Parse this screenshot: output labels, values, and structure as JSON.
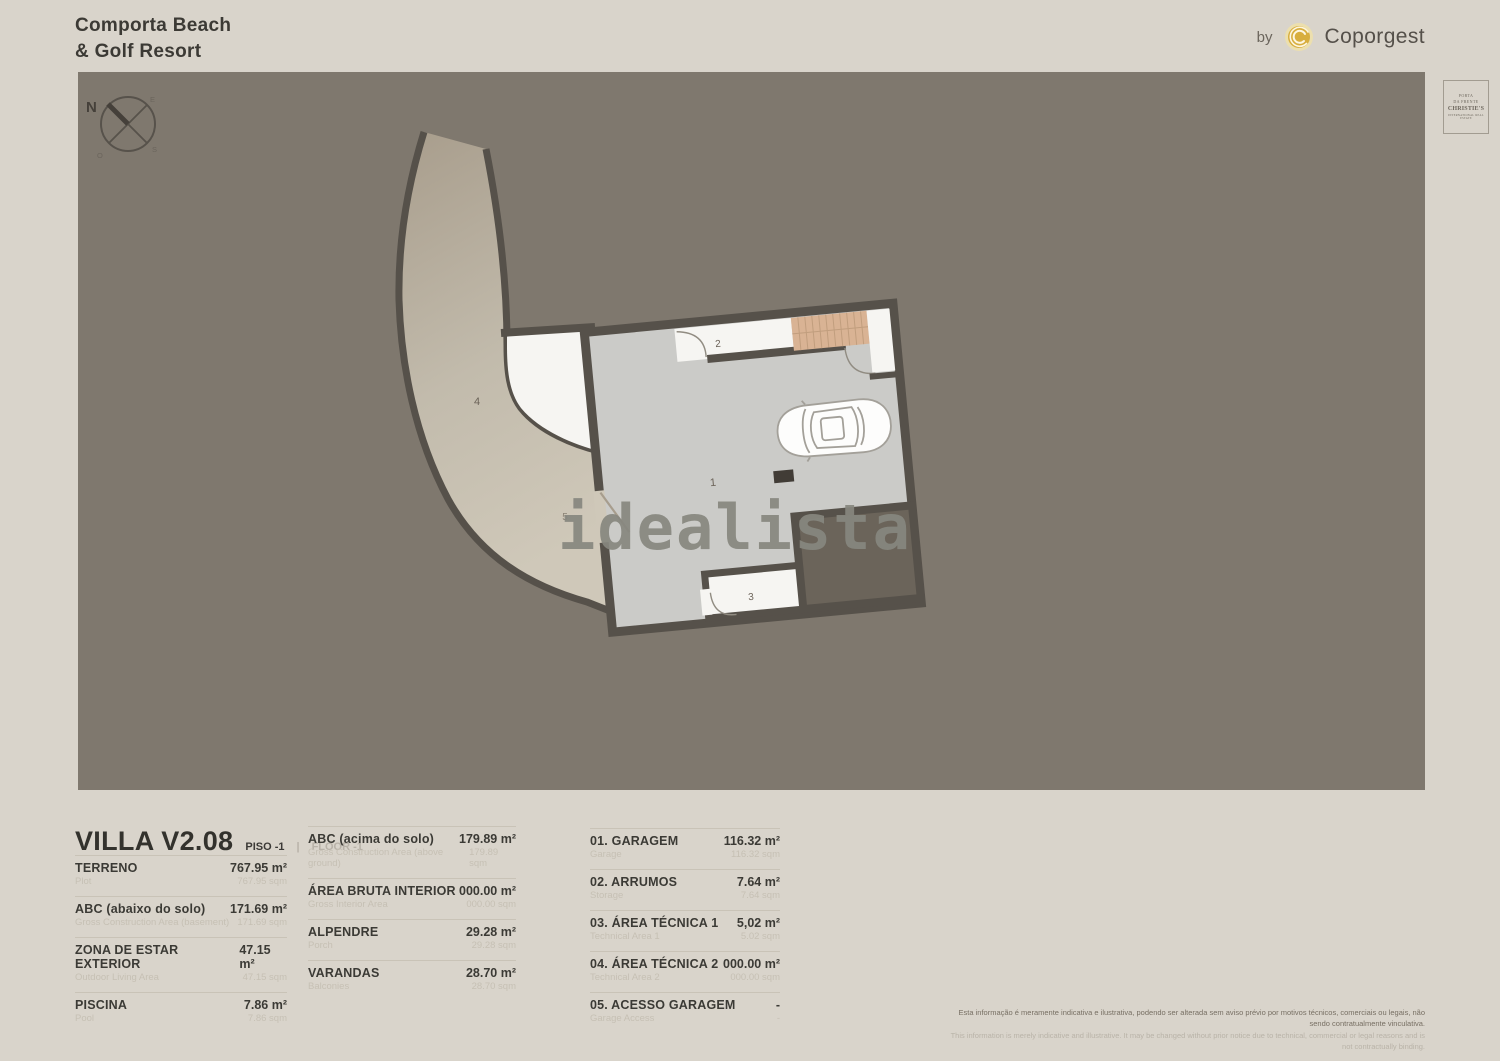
{
  "header": {
    "title_line1": "Comporta Beach",
    "title_line2": "& Golf Resort",
    "by_label": "by",
    "brand_name": "Coporgest"
  },
  "christies": {
    "affiliate_line1": "PORTA",
    "affiliate_line2": "DA FRENTE",
    "name": "CHRISTIE'S",
    "tagline": "INTERNATIONAL REAL ESTATE"
  },
  "plan": {
    "watermark": "idealista",
    "compass": {
      "n": "N",
      "e": "E",
      "s": "S",
      "w": "O"
    },
    "rooms": {
      "garage": "1",
      "hall": "2",
      "storage": "3",
      "tech": "4",
      "driveway": "5"
    }
  },
  "info": {
    "title": "VILLA V2.08",
    "floor_pt": "PISO -1",
    "separator": "|",
    "floor_en": "FLOOR -1",
    "col1": [
      {
        "label": "TERRENO",
        "sub": "Plot",
        "value": "767.95 m²",
        "subvalue": "767.95 sqm"
      },
      {
        "label": "ABC (abaixo do solo)",
        "sub": "Gross Construction Area (basement)",
        "value": "171.69 m²",
        "subvalue": "171.69 sqm"
      },
      {
        "label": "ZONA DE ESTAR EXTERIOR",
        "sub": "Outdoor Living Area",
        "value": "47.15 m²",
        "subvalue": "47.15 sqm"
      },
      {
        "label": "PISCINA",
        "sub": "Pool",
        "value": "7.86 m²",
        "subvalue": "7.86 sqm"
      }
    ],
    "col2": [
      {
        "label": "ABC (acima do solo)",
        "sub": "Gross Construction Area (above ground)",
        "value": "179.89 m²",
        "subvalue": "179.89 sqm"
      },
      {
        "label": "ÁREA BRUTA INTERIOR",
        "sub": "Gross Interior Area",
        "value": "000.00 m²",
        "subvalue": "000.00 sqm"
      },
      {
        "label": "ALPENDRE",
        "sub": "Porch",
        "value": "29.28 m²",
        "subvalue": "29.28 sqm"
      },
      {
        "label": "VARANDAS",
        "sub": "Balconies",
        "value": "28.70 m²",
        "subvalue": "28.70 sqm"
      }
    ],
    "col3": [
      {
        "label": "01. GARAGEM",
        "sub": "Garage",
        "value": "116.32 m²",
        "subvalue": "116.32 sqm"
      },
      {
        "label": "02. ARRUMOS",
        "sub": "Storage",
        "value": "7.64 m²",
        "subvalue": "7.64 sqm"
      },
      {
        "label": "03. ÁREA TÉCNICA 1",
        "sub": "Technical Area 1",
        "value": "5,02 m²",
        "subvalue": "5.02 sqm"
      },
      {
        "label": "04. ÁREA TÉCNICA 2",
        "sub": "Technical Area 2",
        "value": "000.00 m²",
        "subvalue": "000.00 sqm"
      },
      {
        "label": "05. ACESSO GARAGEM",
        "sub": "Garage Access",
        "value": "-",
        "subvalue": "-"
      }
    ]
  },
  "disclaimer": {
    "pt": "Esta informação é meramente indicativa e ilustrativa, podendo ser alterada sem aviso prévio por motivos técnicos, comerciais ou legais, não sendo contratualmente vinculativa.",
    "en": "This information is merely indicative and illustrative. It may be changed without prior notice due to technical, commercial or legal reasons and is not contractually binding."
  },
  "colors": {
    "page_bg": "#d9d4cb",
    "plan_bg": "#7f786e",
    "wall": "#56514a",
    "floor": "#cbcbc8",
    "room_white": "#f6f5f2",
    "stairs": "#d9b394",
    "patio": "#6b645a",
    "drv_dark": "#a89d8c",
    "drv_light": "#cfc8b9",
    "gold": "#d8ae3e",
    "watermark": "#87877f"
  }
}
